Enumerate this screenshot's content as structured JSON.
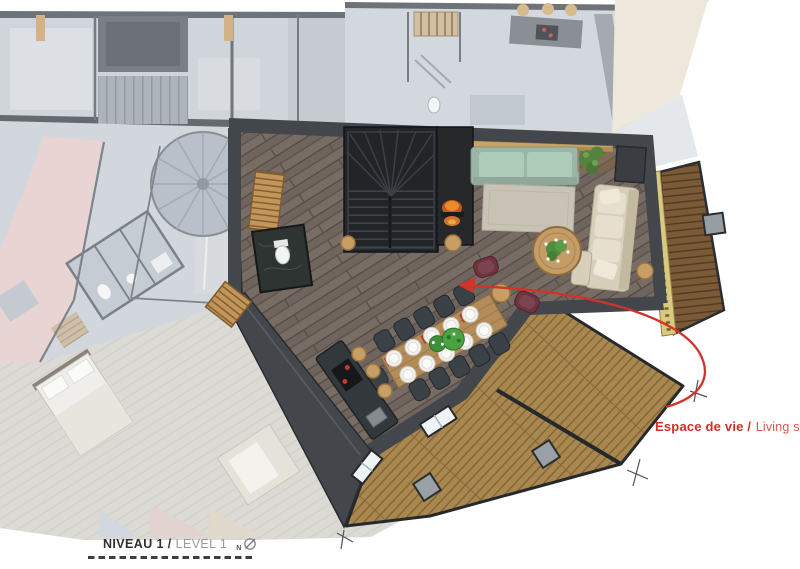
{
  "annotation": {
    "label_bold": "Espace de vie /",
    "label_light": "Living space"
  },
  "title_block": {
    "level_bold": "NIVEAU 1 /",
    "level_light": "LEVEL 1",
    "north_letter": "N"
  },
  "palette": {
    "accent_red": "#d13329",
    "wall_dark": "#43474c",
    "floor_wood": "#6f655e",
    "deck_wood": "#a9884f",
    "balcony_wood": "#7b5a38",
    "sofa_green": "#9db5a6",
    "sofa_cream": "#d8cfbb",
    "armchair_plum": "#6e3440",
    "faded_wash": "#c8ced6",
    "hall_pink": "#e3cac7",
    "title_dark": "#303030",
    "title_grey": "#9b9b9b"
  }
}
